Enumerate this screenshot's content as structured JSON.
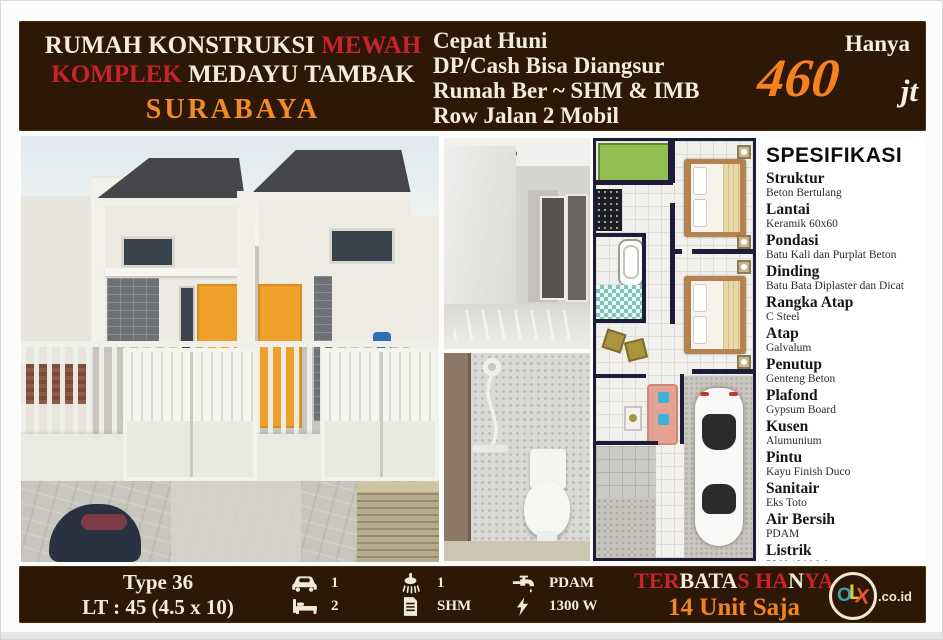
{
  "header": {
    "left": {
      "line1": [
        {
          "text": "RUMAH KONSTRUKSI ",
          "color": "white"
        },
        {
          "text": "MEWAH",
          "color": "red"
        }
      ],
      "line2": [
        {
          "text": "KOMPLEK ",
          "color": "red"
        },
        {
          "text": "MEDAYU TAMBAK",
          "color": "white"
        }
      ],
      "line3": "SURABAYA"
    },
    "middle_lines": [
      "Cepat Huni",
      "DP/Cash Bisa Diangsur",
      "Rumah Ber ~ SHM & IMB",
      "Row Jalan 2 Mobil"
    ],
    "price": {
      "prefix": "Hanya",
      "amount": "460",
      "unit": "jt"
    }
  },
  "photos": {
    "main": "twin-minimalist-houses-exterior",
    "interior": "empty-room-interior",
    "bathroom": "bathroom-with-toilet-and-shower",
    "floorplan": "top-view-floor-plan"
  },
  "specs": {
    "title": "SPESIFIKASI",
    "items": [
      {
        "label": "Struktur",
        "value": "Beton Bertulang"
      },
      {
        "label": "Lantai",
        "value": "Keramik 60x60"
      },
      {
        "label": "Pondasi",
        "value": "Batu Kali dan Purplat Beton"
      },
      {
        "label": "Dinding",
        "value": "Batu Bata Diplaster dan Dicat"
      },
      {
        "label": "Rangka Atap",
        "value": "C Steel"
      },
      {
        "label": "Atap",
        "value": "Galvalum"
      },
      {
        "label": "Penutup",
        "value": "Genteng Beton"
      },
      {
        "label": "Plafond",
        "value": "Gypsum Board"
      },
      {
        "label": "Kusen",
        "value": "Alumunium"
      },
      {
        "label": "Pintu",
        "value": "Kayu Finish Duco"
      },
      {
        "label": "Sanitair",
        "value": "Eks Toto"
      },
      {
        "label": "Air Bersih",
        "value": "PDAM"
      },
      {
        "label": "Listrik",
        "value": "PLN 1300 Watt"
      }
    ]
  },
  "footer": {
    "type_line": "Type 36",
    "lt_line": "LT : 45 (4.5 x 10)",
    "features": [
      {
        "icon": "car-icon",
        "value": "1"
      },
      {
        "icon": "shower-icon",
        "value": "1"
      },
      {
        "icon": "faucet-icon",
        "value": "PDAM"
      },
      {
        "icon": "bed-icon",
        "value": "2"
      },
      {
        "icon": "document-icon",
        "value": "SHM"
      },
      {
        "icon": "bolt-icon",
        "value": "1300 W"
      }
    ],
    "limited_line1": [
      {
        "text": "TER",
        "color": "red"
      },
      {
        "text": "BATA",
        "color": "white"
      },
      {
        "text": "S HA",
        "color": "red"
      },
      {
        "text": "N",
        "color": "white"
      },
      {
        "text": "YA",
        "color": "red"
      }
    ],
    "limited_line2": "14 Unit Saja",
    "olx": {
      "o": "O",
      "l": "L",
      "x": "X",
      "suffix": ".co.id"
    }
  },
  "colors": {
    "bar_brown": "#2d1706",
    "cream_text": "#f3ecdc",
    "red_text": "#c8232b",
    "orange_text": "#ef8c28",
    "price_orange": "#f5821f",
    "plan_wall_navy": "#1d1d3a",
    "door_orange": "#efa02b",
    "olx_o": "#37a0b5",
    "olx_l": "#dfc63c",
    "olx_x": "#e4582c"
  }
}
